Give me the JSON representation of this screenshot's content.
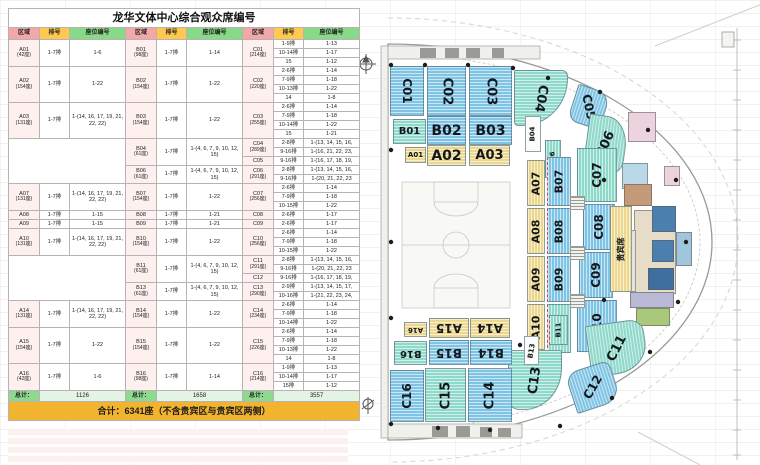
{
  "title": "龙华文体中心综合观众席编号",
  "colors": {
    "blue": "#7fc4e4",
    "teal": "#8fd9ca",
    "yellow": "#edd78c",
    "header_zone": "#f2a8a8",
    "header_row": "#ffc94f",
    "header_seat": "#88d988",
    "zone_cell": "#fdf0ee",
    "total_label": "#8fd98f",
    "total_value": "#e4f4e4",
    "grand_bg": "#f2b32e"
  },
  "table": {
    "headers": [
      "区域",
      "排号",
      "座位编号"
    ],
    "bands": [
      {
        "a": {
          "zone": "A01",
          "sub": "(42座)",
          "row": "1-7排",
          "seat": "1-6"
        },
        "b": [
          {
            "zone": "B01",
            "sub": "(98座)",
            "row": "1-7排",
            "seat": "1-14",
            "span": 3
          }
        ],
        "c": [
          {
            "zone": "C01",
            "sub": "(214座)",
            "rows": [
              [
                "1-9排",
                "1-13"
              ],
              [
                "10-14排",
                "1-17"
              ],
              [
                "15",
                "1-12"
              ]
            ]
          }
        ]
      },
      {
        "a": {
          "zone": "A02",
          "sub": "(154座)",
          "row": "1-7排",
          "seat": "1-22"
        },
        "b": [
          {
            "zone": "B02",
            "sub": "(154座)",
            "row": "1-7排",
            "seat": "1-22",
            "span": 4
          }
        ],
        "c": [
          {
            "zone": "C02",
            "sub": "(220座)",
            "rows": [
              [
                "2-6排",
                "1-14"
              ],
              [
                "7-9排",
                "1-18"
              ],
              [
                "10-13排",
                "1-22"
              ],
              [
                "14",
                "1-8"
              ]
            ]
          }
        ]
      },
      {
        "a": {
          "zone": "A03",
          "sub": "(131座)",
          "row": "1-7排",
          "seat": "1-(14, 16, 17, 19, 21, 22, 22)"
        },
        "b": [
          {
            "zone": "B03",
            "sub": "(154座)",
            "row": "1-7排",
            "seat": "1-22",
            "span": 4
          }
        ],
        "c": [
          {
            "zone": "C03",
            "sub": "(255座)",
            "rows": [
              [
                "2-6排",
                "1-14"
              ],
              [
                "7-9排",
                "1-18"
              ],
              [
                "10-14排",
                "1-22"
              ],
              [
                "15",
                "1-21"
              ]
            ]
          }
        ]
      },
      {
        "a": null,
        "b": [
          {
            "zone": "B04",
            "sub": "(61座)",
            "row": "1-7排",
            "seat": "1-(4, 6, 7, 9, 10, 12, 15)",
            "span": 3
          },
          {
            "zone": "B06",
            "sub": "(61座)",
            "row": "1-7排",
            "seat": "1-(4, 6, 7, 9, 10, 12, 15)",
            "span": 2
          }
        ],
        "c": [
          {
            "zone": "C04",
            "sub": "(289座)",
            "rows": [
              [
                "2-8排",
                "1-(13, 14, 15, 16,"
              ],
              [
                "9-16排",
                "1-(16, 21, 22, 23,"
              ]
            ]
          },
          {
            "zone": "C05",
            "sub": "",
            "rows": [
              [
                "9-16排",
                "1-(16, 17, 18, 19,"
              ]
            ]
          },
          {
            "zone": "C06",
            "sub": "(291座)",
            "rows": [
              [
                "2-8排",
                "1-(13, 14, 15, 16,"
              ],
              [
                "9-16排",
                "1-(20, 21, 22, 23"
              ]
            ]
          }
        ]
      },
      {
        "a": {
          "zone": "A07",
          "sub": "(131座)",
          "row": "1-7排",
          "seat": "1-(14, 16, 17, 19, 21, 22, 22)"
        },
        "b": [
          {
            "zone": "B07",
            "sub": "(154座)",
            "row": "1-7排",
            "seat": "1-22",
            "span": 3
          }
        ],
        "c": [
          {
            "zone": "C07",
            "sub": "(256座)",
            "rows": [
              [
                "2-6排",
                "1-14"
              ],
              [
                "7-9排",
                "1-18"
              ],
              [
                "10-15排",
                "1-22"
              ]
            ]
          }
        ]
      },
      {
        "a": {
          "zone": "A08",
          "sub": "",
          "row": "1-7排",
          "seat": "1-15"
        },
        "b": [
          {
            "zone": "B08",
            "sub": "",
            "row": "1-7排",
            "seat": "1-21",
            "span": 1
          }
        ],
        "c": [
          {
            "zone": "C08",
            "sub": "",
            "rows": [
              [
                "2-6排",
                "1-17"
              ]
            ]
          }
        ]
      },
      {
        "a": {
          "zone": "A09",
          "sub": "",
          "row": "1-7排",
          "seat": "1-15"
        },
        "b": [
          {
            "zone": "B09",
            "sub": "",
            "row": "1-7排",
            "seat": "1-21",
            "span": 1
          }
        ],
        "c": [
          {
            "zone": "C09",
            "sub": "",
            "rows": [
              [
                "2-6排",
                "1-17"
              ]
            ]
          }
        ]
      },
      {
        "a": {
          "zone": "A10",
          "sub": "(131座)",
          "row": "1-7排",
          "seat": "1-(14, 16, 17, 19, 21, 22, 22)"
        },
        "b": [
          {
            "zone": "B10",
            "sub": "(154座)",
            "row": "1-7排",
            "seat": "1-22",
            "span": 3
          }
        ],
        "c": [
          {
            "zone": "C10",
            "sub": "(256座)",
            "rows": [
              [
                "2-6排",
                "1-14"
              ],
              [
                "7-9排",
                "1-18"
              ],
              [
                "10-15排",
                "1-22"
              ]
            ]
          }
        ]
      },
      {
        "a": null,
        "b": [
          {
            "zone": "B11",
            "sub": "(61座)",
            "row": "1-7排",
            "seat": "1-(4, 6, 7, 9, 10, 12, 15)",
            "span": 3
          },
          {
            "zone": "B13",
            "sub": "(61座)",
            "row": "1-7排",
            "seat": "1-(4, 6, 7, 9, 10, 12, 15)",
            "span": 2
          }
        ],
        "c": [
          {
            "zone": "C11",
            "sub": "(291座)",
            "rows": [
              [
                "2-8排",
                "1-(13, 14, 15, 16,"
              ],
              [
                "9-16排",
                "1-(20, 21, 22, 23"
              ]
            ]
          },
          {
            "zone": "C12",
            "sub": "",
            "rows": [
              [
                "9-16排",
                "1-(16, 17, 18, 19,"
              ]
            ]
          },
          {
            "zone": "C13",
            "sub": "(290座)",
            "rows": [
              [
                "2-9排",
                "1-(13, 14, 15, 17,"
              ],
              [
                "10-16排",
                "1-(21, 22, 23, 24,"
              ]
            ]
          }
        ]
      },
      {
        "a": {
          "zone": "A14",
          "sub": "(131座)",
          "row": "1-7排",
          "seat": "1-(14, 16, 17, 19, 21, 22, 22)"
        },
        "b": [
          {
            "zone": "B14",
            "sub": "(154座)",
            "row": "1-7排",
            "seat": "1-22",
            "span": 3
          }
        ],
        "c": [
          {
            "zone": "C14",
            "sub": "(234座)",
            "rows": [
              [
                "2-6排",
                "1-14"
              ],
              [
                "7-9排",
                "1-18"
              ],
              [
                "10-14排",
                "1-22"
              ]
            ]
          }
        ]
      },
      {
        "a": {
          "zone": "A15",
          "sub": "(154座)",
          "row": "1-7排",
          "seat": "1-22"
        },
        "b": [
          {
            "zone": "B15",
            "sub": "(154座)",
            "row": "1-7排",
            "seat": "1-22",
            "span": 4
          }
        ],
        "c": [
          {
            "zone": "C15",
            "sub": "(226座)",
            "rows": [
              [
                "2-6排",
                "1-14"
              ],
              [
                "7-9排",
                "1-18"
              ],
              [
                "10-13排",
                "1-22"
              ],
              [
                "14",
                "1-8"
              ]
            ]
          }
        ]
      },
      {
        "a": {
          "zone": "A16",
          "sub": "(42座)",
          "row": "1-7排",
          "seat": "1-6"
        },
        "b": [
          {
            "zone": "B16",
            "sub": "(98座)",
            "row": "1-7排",
            "seat": "1-14",
            "span": 3
          }
        ],
        "c": [
          {
            "zone": "C16",
            "sub": "(214座)",
            "rows": [
              [
                "1-9排",
                "1-13"
              ],
              [
                "10-14排",
                "1-17"
              ],
              [
                "15排",
                "1-12"
              ]
            ]
          }
        ]
      }
    ],
    "totals": {
      "label": "总计：",
      "values": [
        "1126",
        "1658",
        "3557"
      ]
    },
    "grand_total": "合计：6341座（不含贵宾区与贵宾区两侧）"
  },
  "map": {
    "sections": [
      {
        "id": "C01",
        "label": "C01",
        "color": "blue"
      },
      {
        "id": "C02",
        "label": "C02",
        "color": "blue"
      },
      {
        "id": "C03",
        "label": "C03",
        "color": "blue"
      },
      {
        "id": "C04",
        "label": "C04",
        "color": "teal"
      },
      {
        "id": "C05",
        "label": "C05",
        "color": "blue"
      },
      {
        "id": "C06",
        "label": "C06",
        "color": "teal"
      },
      {
        "id": "B01",
        "label": "B01",
        "color": "teal"
      },
      {
        "id": "B02",
        "label": "B02",
        "color": "blue"
      },
      {
        "id": "B03",
        "label": "B03",
        "color": "blue"
      },
      {
        "id": "B04",
        "label": "B04",
        "color": "white"
      },
      {
        "id": "A01",
        "label": "A01",
        "color": "yellow"
      },
      {
        "id": "A02",
        "label": "A02",
        "color": "yellow"
      },
      {
        "id": "A03",
        "label": "A03",
        "color": "yellow"
      },
      {
        "id": "B06",
        "label": "B06",
        "color": "teal"
      },
      {
        "id": "A07",
        "label": "A07",
        "color": "yellow"
      },
      {
        "id": "A08",
        "label": "A08",
        "color": "yellow"
      },
      {
        "id": "A09",
        "label": "A09",
        "color": "yellow"
      },
      {
        "id": "A10",
        "label": "A10",
        "color": "yellow"
      },
      {
        "id": "B07",
        "label": "B07",
        "color": "blue"
      },
      {
        "id": "B08",
        "label": "B08",
        "color": "blue"
      },
      {
        "id": "B09",
        "label": "B09",
        "color": "blue"
      },
      {
        "id": "B10",
        "label": "B10",
        "color": "teal"
      },
      {
        "id": "C07",
        "label": "C07",
        "color": "teal"
      },
      {
        "id": "C08",
        "label": "C08",
        "color": "blue"
      },
      {
        "id": "C09",
        "label": "C09",
        "color": "blue"
      },
      {
        "id": "C10",
        "label": "C10",
        "color": "blue"
      },
      {
        "id": "VIP",
        "label": "贵宾席",
        "color": "yellow"
      },
      {
        "id": "C11",
        "label": "C11",
        "color": "teal"
      },
      {
        "id": "C12",
        "label": "C12",
        "color": "blue"
      },
      {
        "id": "C13",
        "label": "C13",
        "color": "teal"
      },
      {
        "id": "B11",
        "label": "B11",
        "color": "teal"
      },
      {
        "id": "B13",
        "label": "B13",
        "color": "white"
      },
      {
        "id": "A14",
        "label": "A14",
        "color": "yellow"
      },
      {
        "id": "A15",
        "label": "A15",
        "color": "yellow"
      },
      {
        "id": "A16",
        "label": "A16",
        "color": "yellow"
      },
      {
        "id": "B14",
        "label": "B14",
        "color": "blue"
      },
      {
        "id": "B15",
        "label": "B15",
        "color": "blue"
      },
      {
        "id": "B16",
        "label": "B16",
        "color": "teal"
      },
      {
        "id": "C14",
        "label": "C14",
        "color": "blue"
      },
      {
        "id": "C15",
        "label": "C15",
        "color": "teal"
      },
      {
        "id": "C16",
        "label": "C16",
        "color": "blue"
      }
    ]
  }
}
